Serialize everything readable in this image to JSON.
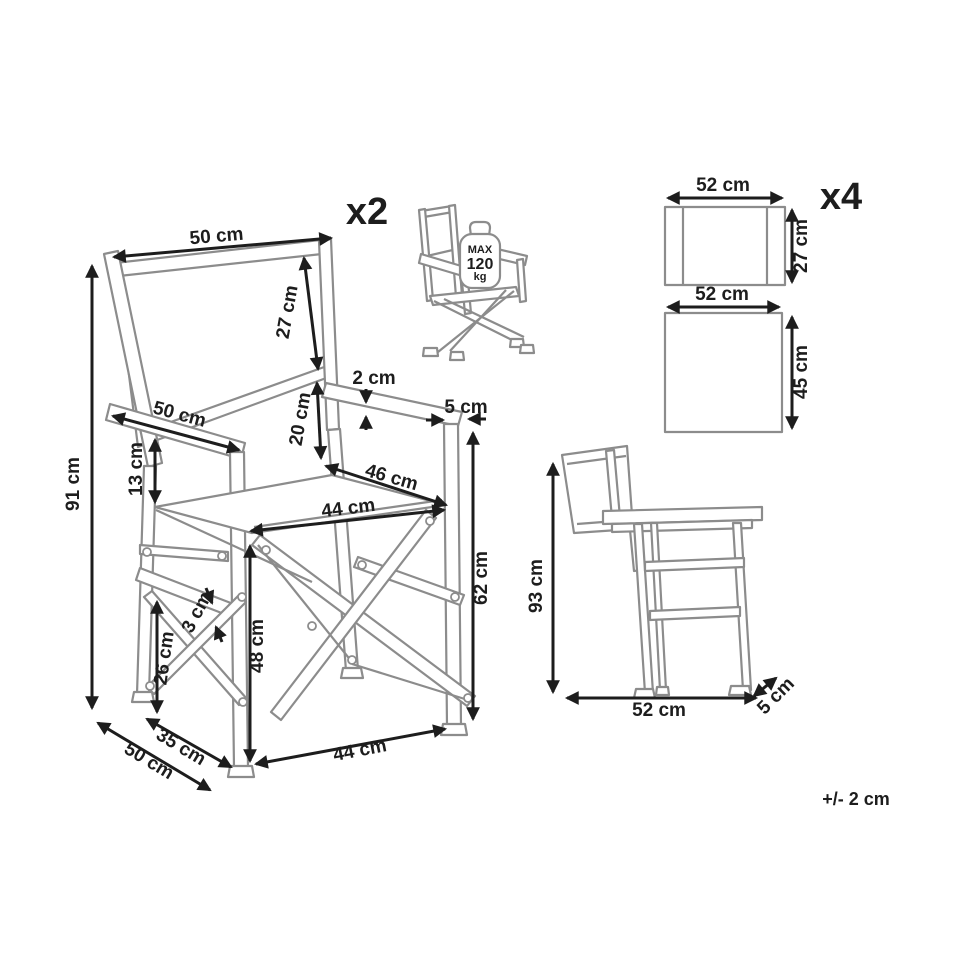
{
  "diagram": {
    "tolerance": "+/- 2 cm",
    "line_color": "#8c8c8c",
    "dimension_color": "#1d1d1d"
  },
  "front_view": {
    "quantity": "x2",
    "max_load": {
      "label": "MAX",
      "value": "120",
      "unit": "kg"
    },
    "dims": {
      "backrest_width": "50 cm",
      "backrest_height": "27 cm",
      "armrest_thickness": "2 cm",
      "armrest_width": "5 cm",
      "backrest_to_seat": "20 cm",
      "seat_depth": "46 cm",
      "seat_width": "44 cm",
      "armrest_length": "50 cm",
      "armrest_to_seat": "13 cm",
      "total_height": "91 cm",
      "side_rail_height": "26 cm",
      "side_rail_thickness": "3 cm",
      "seat_height": "48 cm",
      "armrest_floor_height": "62 cm",
      "leg_stance_depth": "35 cm",
      "total_depth": "50 cm",
      "front_leg_span": "44 cm"
    }
  },
  "fabric_panels": {
    "quantity": "x4",
    "backrest_panel": {
      "width": "52 cm",
      "height": "27 cm"
    },
    "seat_panel": {
      "width": "52 cm",
      "height": "45 cm"
    }
  },
  "side_view": {
    "dims": {
      "total_height": "93 cm",
      "total_depth": "52 cm",
      "frame_thickness": "5 cm"
    }
  }
}
